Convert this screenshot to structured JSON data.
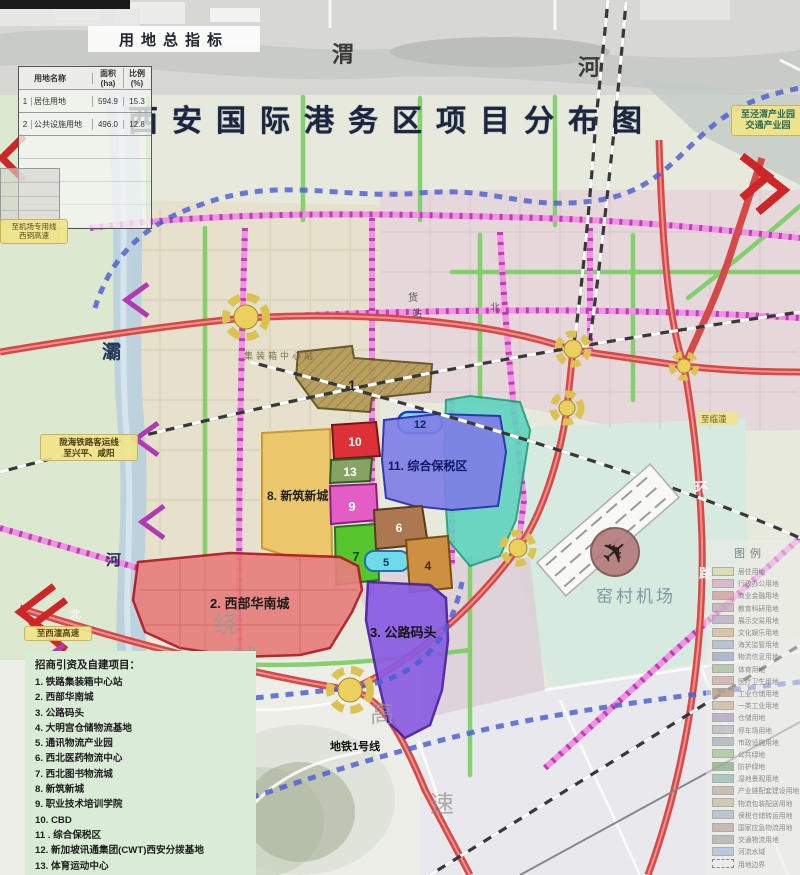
{
  "title": "西安国际港务区项目分布图",
  "indicator_table": {
    "title": "用地总指标",
    "headers": {
      "name": "用地名称",
      "area": "面积(ha)",
      "pct": "比例(%)"
    },
    "rows": [
      {
        "no": "1",
        "name": "居住用地",
        "area": "594.9",
        "pct": "15.3"
      },
      {
        "no": "2",
        "name": "公共设施用地",
        "area": "496.0",
        "pct": "12.8"
      }
    ]
  },
  "projects_legend": {
    "title": "招商引资及自建项目：",
    "items": [
      "1. 铁路集装箱中心站",
      "2. 西部华南城",
      "3. 公路码头",
      "4. 大明宫仓储物流基地",
      "5. 通讯物流产业园",
      "6. 西北医药物流中心",
      "7. 西北图书物流城",
      "8. 新筑新城",
      "9. 职业技术培训学院",
      "10. CBD",
      "11 . 综合保税区",
      "12. 新加坡讯通集团(CWT)西安分拨基地",
      "13. 体育运动中心"
    ]
  },
  "map_legend": {
    "title": "图例",
    "items": [
      {
        "label": "居住用地",
        "color": "#d8d89a"
      },
      {
        "label": "行政办公用地",
        "color": "#d8a8c0"
      },
      {
        "label": "商业金融用地",
        "color": "#d89898"
      },
      {
        "label": "教育科研用地",
        "color": "#c8a8b8"
      },
      {
        "label": "展示交易用地",
        "color": "#b8a8c8"
      },
      {
        "label": "文化娱乐用地",
        "color": "#d8b898"
      },
      {
        "label": "海关监管用地",
        "color": "#a8b8d0"
      },
      {
        "label": "物流信息用地",
        "color": "#98a8c8"
      },
      {
        "label": "体育用地",
        "color": "#a8c098"
      },
      {
        "label": "医疗卫生用地",
        "color": "#d0a8a8"
      },
      {
        "label": "工业仓储用地",
        "color": "#b89878"
      },
      {
        "label": "一类工业用地",
        "color": "#c8b898"
      },
      {
        "label": "仓储用地",
        "color": "#b0a0c0"
      },
      {
        "label": "停车场用地",
        "color": "#b8b8b8"
      },
      {
        "label": "市政设施用地",
        "color": "#a8b0b8"
      },
      {
        "label": "公共绿地",
        "color": "#a0c890"
      },
      {
        "label": "防护绿地",
        "color": "#88b080"
      },
      {
        "label": "湿地景观用地",
        "color": "#90c0b0"
      },
      {
        "label": "产业链配套建设用地",
        "color": "#c0b0a0"
      },
      {
        "label": "物流包装配送用地",
        "color": "#c8c0a0"
      },
      {
        "label": "保税仓储转运用地",
        "color": "#b0b8c8"
      },
      {
        "label": "国家应急物流用地",
        "color": "#c0a8a0"
      },
      {
        "label": "交通物流用地",
        "color": "#b0b0a8"
      },
      {
        "label": "河流水域",
        "color": "#a8c0d8"
      },
      {
        "label": "用地边界",
        "color": "#eeeeee"
      }
    ]
  },
  "zones": {
    "z1": {
      "label": "1",
      "fill": "#b49a56"
    },
    "z2": {
      "label": "2. 西部华南城",
      "fill": "#e87f7d"
    },
    "z3": {
      "label": "3. 公路码头",
      "fill": "#8a5ce2"
    },
    "z4": {
      "label": "4",
      "fill": "#cd9040"
    },
    "z5": {
      "label": "5",
      "fill": "#6fdbe8"
    },
    "z6": {
      "label": "6",
      "fill": "#ab7852"
    },
    "z7": {
      "label": "7",
      "fill": "#57c52d"
    },
    "z8": {
      "label": "8. 新筑新城",
      "fill": "#eec667"
    },
    "z9": {
      "label": "9",
      "fill": "#e25ec5"
    },
    "z10": {
      "label": "10",
      "fill": "#dd3138"
    },
    "z11": {
      "label": "11. 综合保税区",
      "fill": "#7f7fe6"
    },
    "z12": {
      "label": "12",
      "fill": "#7fdde9"
    },
    "z13": {
      "label": "13",
      "fill": "#86a364"
    }
  },
  "map_labels": {
    "wei": "渭",
    "he": "河",
    "ba": "灞",
    "ba_he": "河",
    "metro_line1": "地铁1号线",
    "metro_line3": "地铁3号线",
    "airport": "窑村机场",
    "ring_huan": "环",
    "ring_lu": "路",
    "rao": "绕",
    "cheng": "城",
    "gao": "高",
    "su": "速",
    "bei1": "北",
    "bei2": "北",
    "huo": "货",
    "zhan": "站",
    "container_station": "集装箱中心站"
  },
  "callouts": {
    "to_jingwei_line1": "至泾渭产业园",
    "to_jingwei_line2": "交通产业园",
    "to_airport_line1": "至机场专用线",
    "to_airport_line2": "西铜高速",
    "longhai_line1": "陇海铁路客运线",
    "longhai_line2": "至兴平、咸阳",
    "to_xitong": "至西潼高速",
    "to_lintong": "至临潼"
  },
  "colors": {
    "road_red": "#d64949",
    "road_magenta": "#c23ab8",
    "road_green": "#7fcf68",
    "metro_blue": "#4a5ed2",
    "railway": "#383838",
    "interchange": "#ecd05e",
    "river": "#b9cfdd",
    "title": "#1b2740",
    "projects_legend_bg": "#d9ecd6"
  }
}
